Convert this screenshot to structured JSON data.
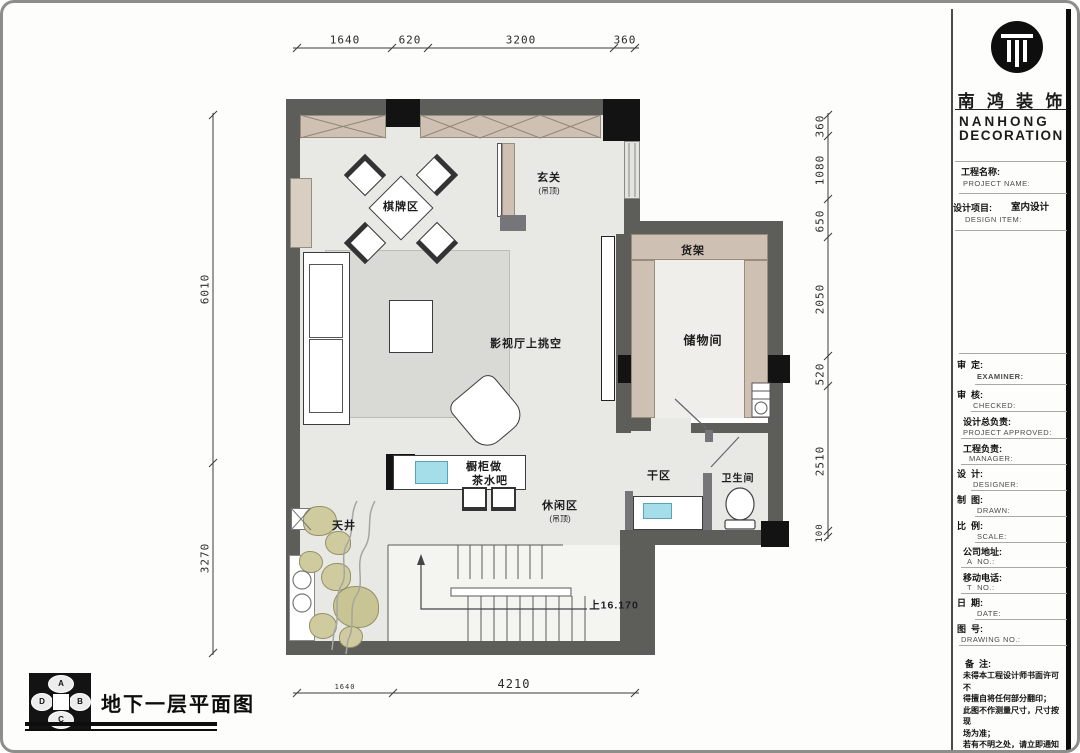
{
  "caption": "地下一层平面图",
  "compass": {
    "top": "A",
    "right": "B",
    "bottom": "C",
    "left": "D"
  },
  "rooms": {
    "qipai": "棋牌区",
    "xuanguan": "玄关",
    "xuanguan_sub": "(吊顶)",
    "huojia": "货架",
    "chuwu": "储物间",
    "yingshi": "影视厅上挑空",
    "chugui_line1": "橱柜做",
    "chugui_line2": "茶水吧",
    "ganqu": "干区",
    "weishengjian": "卫生间",
    "xiuxian": "休闲区",
    "xiuxian_sub": "(吊顶)",
    "tianjing": "天井",
    "stair_note": "上16.170"
  },
  "dims": {
    "top": [
      "1640",
      "620",
      "3200",
      "360"
    ],
    "bottom": [
      "1640",
      "4210"
    ],
    "left": [
      "6010",
      "3270"
    ],
    "right": [
      "360",
      "1080",
      "650",
      "2050",
      "520",
      "2510",
      "100"
    ]
  },
  "titleblock": {
    "brand_cn": "南 鸿 装 饰",
    "brand_en_1": "NANHONG",
    "brand_en_2": "DECORATION",
    "project_cn": "工程名称:",
    "project_en": "PROJECT NAME:",
    "design_cn": "设计项目:",
    "design_en": "DESIGN ITEM:",
    "design_value": "室内设计",
    "examiner_cn": "审  定:",
    "examiner_en": "EXAMINER:",
    "checked_cn": "审  核:",
    "checked_en": "CHECKED:",
    "approved_cn": "设计总负责:",
    "approved_en": "PROJECT APPROVED:",
    "manager_cn": "工程负责:",
    "manager_en": "MANAGER:",
    "designer_cn": "设  计:",
    "designer_en": "DESIGNER:",
    "drawn_cn": "制  图:",
    "drawn_en": "DRAWN:",
    "scale_cn": "比  例:",
    "scale_en": "SCALE:",
    "addr_cn": "公司地址:",
    "addr_en": "A  NO.:",
    "tel_cn": "移动电话:",
    "tel_en": "T  NO.:",
    "date_cn": "日  期:",
    "date_en": "DATE:",
    "no_cn": "图  号:",
    "no_en": "DRAWING NO.:",
    "remark_cn": "备  注:",
    "remark_lines": [
      "未得本工程设计师书面许可不",
      "得擅自将任何部分翻印；",
      "此图不作测量尺寸，尺寸按现",
      "场为准；",
      "若有不明之处，请立即通知设",
      "计师。"
    ]
  },
  "colors": {
    "wall": "#5d5d5a",
    "column": "#131313",
    "cabinet": "#cec1b3",
    "floor": "#e8e8e5",
    "rug": "#d9d9d5",
    "sink": "#a5dde8"
  }
}
